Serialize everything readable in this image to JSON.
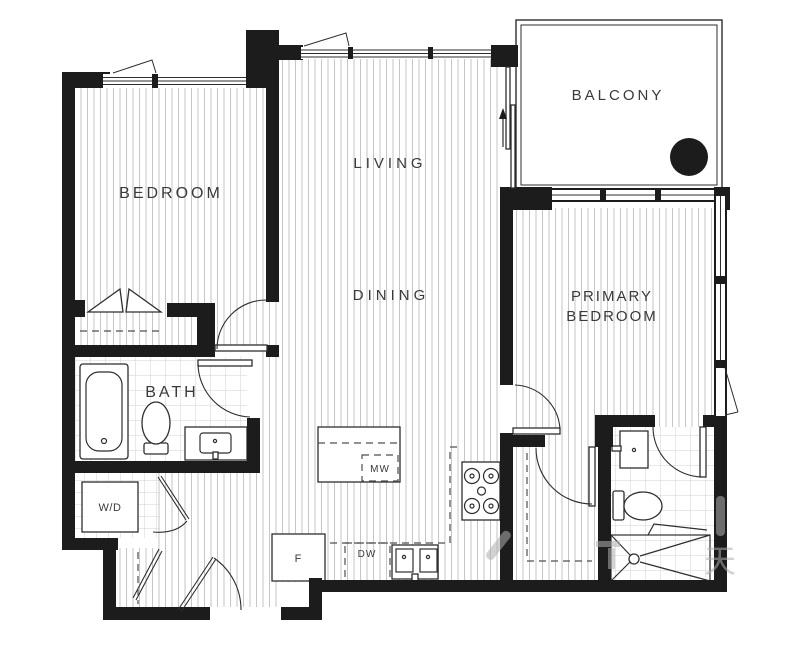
{
  "document": {
    "type": "apartment-floor-plan"
  },
  "colors": {
    "wall": "#1c1c1c",
    "floor_hatch": "#c6c6c6",
    "tile": "#d2d2d2",
    "line": "#2e2e2e",
    "dash": "#4f4f4f",
    "label": "#3a3a3a",
    "watermark": "#aeaeae"
  },
  "rooms": {
    "bedroom": "BEDROOM",
    "living": "LIVING",
    "dining": "DINING",
    "balcony": "BALCONY",
    "primary_bedroom_line1": "PRIMARY",
    "primary_bedroom_line2": "BEDROOM",
    "bath": "BATH",
    "washer_dryer": "W/D"
  },
  "appliances": {
    "microwave": "MW",
    "fridge": "F",
    "dishwasher": "DW"
  },
  "watermark": {
    "glyph": "天"
  }
}
